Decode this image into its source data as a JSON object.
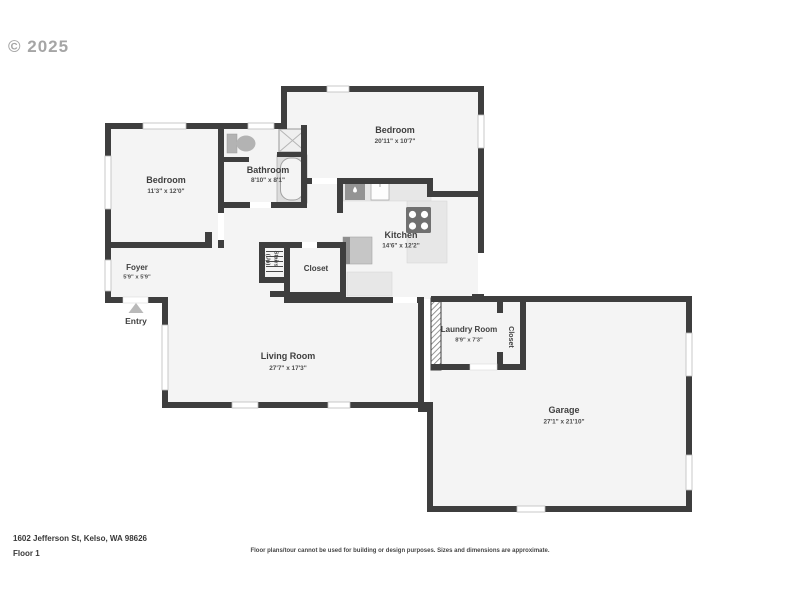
{
  "watermark": "© 2025",
  "rooms": {
    "bedroom_main": {
      "name": "Bedroom",
      "dims": "20'11\" x 10'7\""
    },
    "bedroom_left": {
      "name": "Bedroom",
      "dims": "11'3\" x 12'0\""
    },
    "bathroom": {
      "name": "Bathroom",
      "dims": "8'10\" x 8'1\""
    },
    "kitchen": {
      "name": "Kitchen",
      "dims": "14'6\" x 12'2\""
    },
    "foyer": {
      "name": "Foyer",
      "dims": "5'9\" x 5'9\""
    },
    "living_room": {
      "name": "Living Room",
      "dims": "27'7\" x 17'3\""
    },
    "laundry_room": {
      "name": "Laundry Room",
      "dims": "8'9\" x 7'3\""
    },
    "garage": {
      "name": "Garage",
      "dims": "27'1\" x 21'10\""
    },
    "closet_hall": {
      "name": "Closet"
    },
    "closet_laundry": {
      "name": "Closet"
    },
    "stairs": {
      "line1": "Stairs",
      "line2": "(Up)"
    },
    "entry": {
      "name": "Entry"
    }
  },
  "footer": {
    "address": "1602 Jefferson St, Kelso, WA 98626",
    "floor_label": "Floor 1",
    "disclaimer": "Floor plans/tour cannot be used for building or design purposes. Sizes and dimensions are approximate."
  },
  "colors": {
    "wall": "#3e3e3e",
    "floor": "#f4f4f4",
    "counter": "#e7e7e7",
    "appliance_dark": "#707070",
    "fixture_gray": "#b3b3b3"
  }
}
